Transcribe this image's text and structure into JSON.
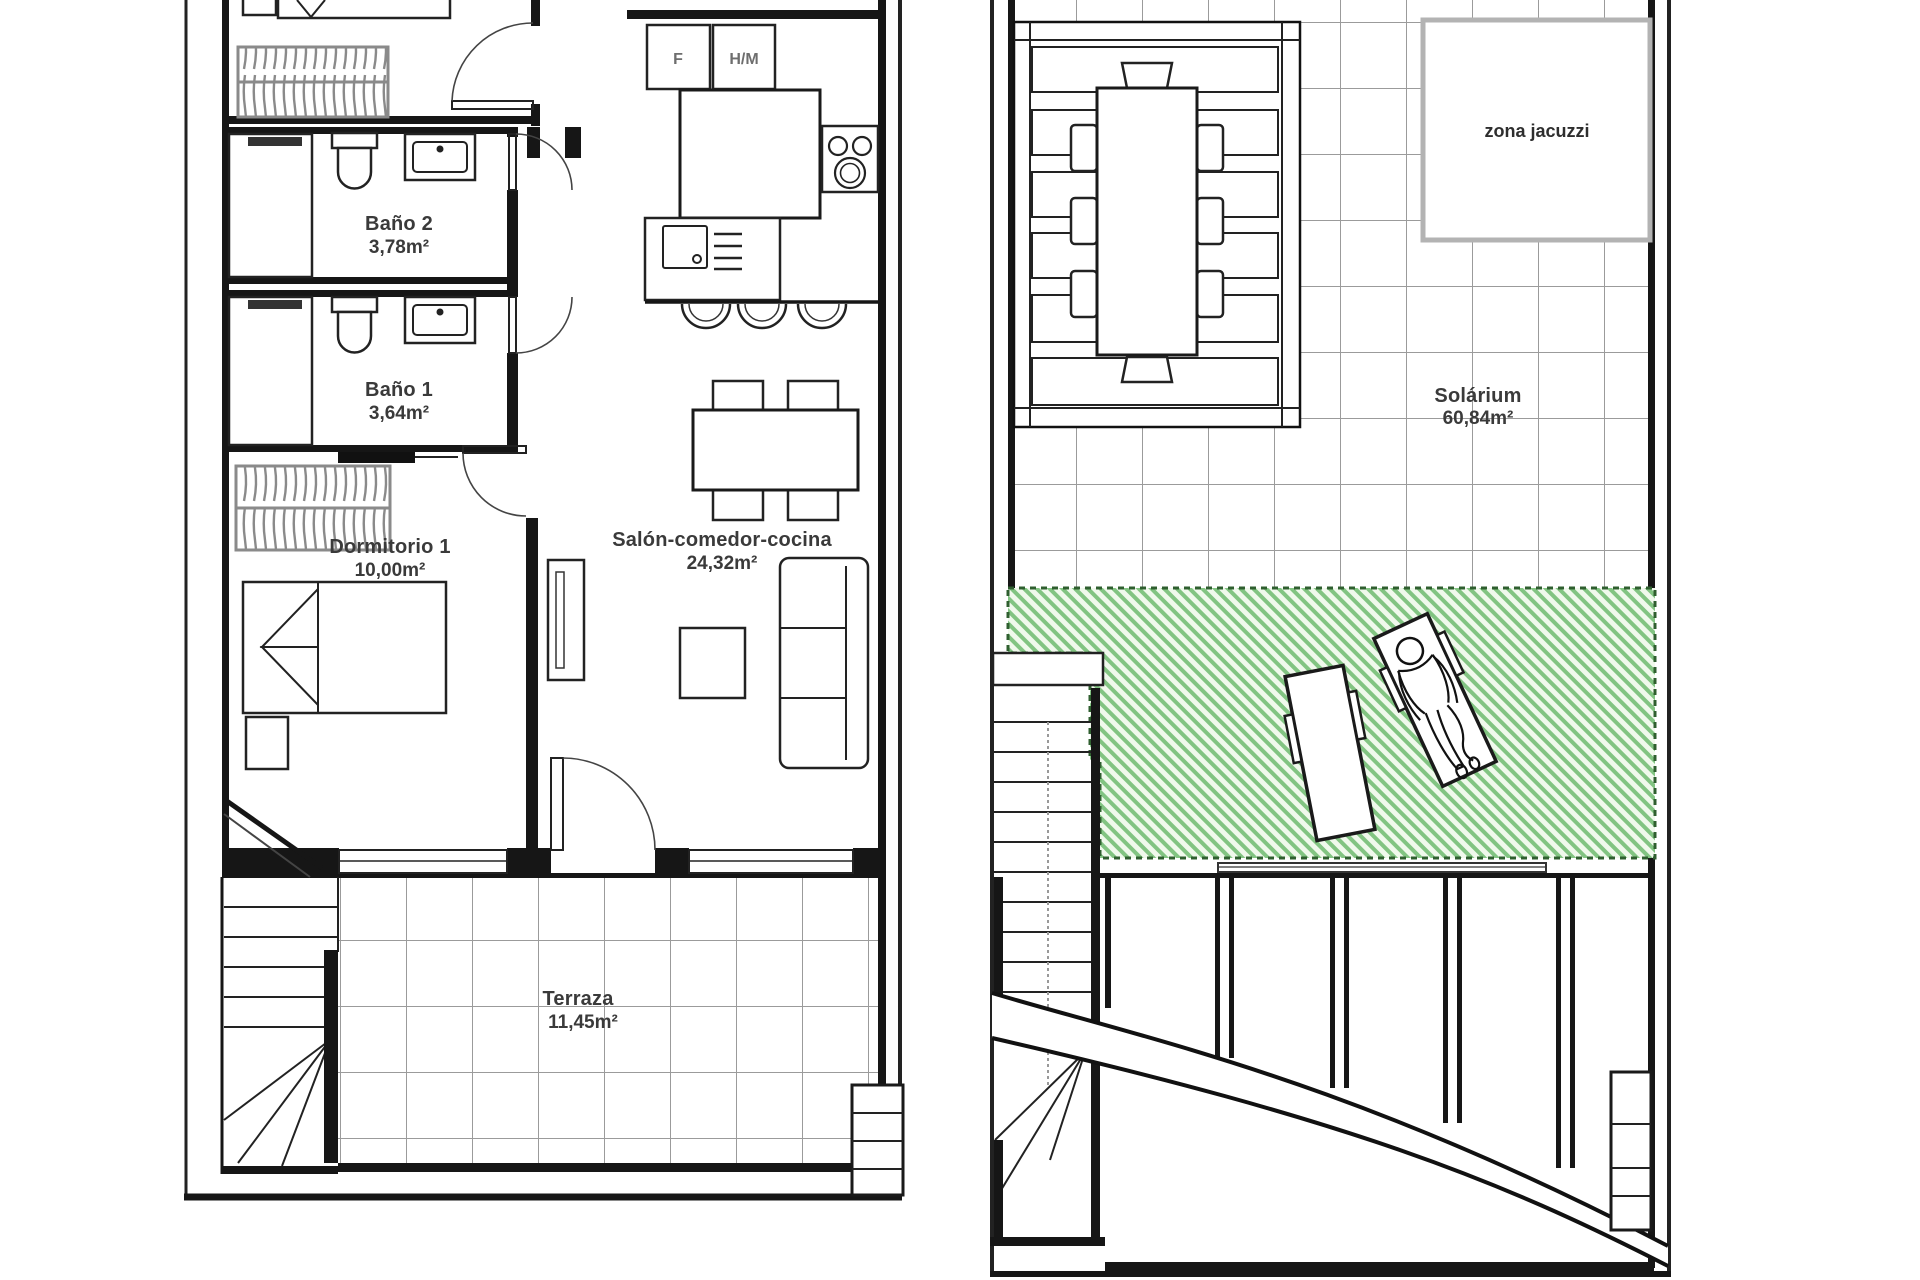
{
  "document": {
    "type": "floor-plan",
    "panels": [
      "first-floor-apartment",
      "solarium-roof"
    ]
  },
  "first_floor": {
    "rooms": {
      "bano2": {
        "name": "Baño 2",
        "area": "3,78m²"
      },
      "bano1": {
        "name": "Baño 1",
        "area": "3,64m²"
      },
      "dormitorio1": {
        "name": "Dormitorio 1",
        "area": "10,00m²"
      },
      "salon": {
        "name": "Salón-comedor-cocina",
        "area": "24,32m²"
      },
      "terraza": {
        "name": "Terraza",
        "area": "11,45m²"
      }
    },
    "appliances": {
      "fridge": "F",
      "oven_microwave": "H/M"
    }
  },
  "solarium_floor": {
    "rooms": {
      "solarium": {
        "name": "Solárium",
        "area": "60,84m²"
      },
      "jacuzzi": {
        "name": "zona jacuzzi"
      }
    }
  },
  "colors": {
    "wall": "#161616",
    "grid_line": "#9b9b9b",
    "green_hatch_line": "#82c482",
    "green_hatch_bg": "#f0f9ec",
    "green_border": "#2f5f2f",
    "jacuzzi_border": "#b3b3b3",
    "label_text": "#3a3a3a",
    "appliance_text": "#6e6e6e"
  }
}
